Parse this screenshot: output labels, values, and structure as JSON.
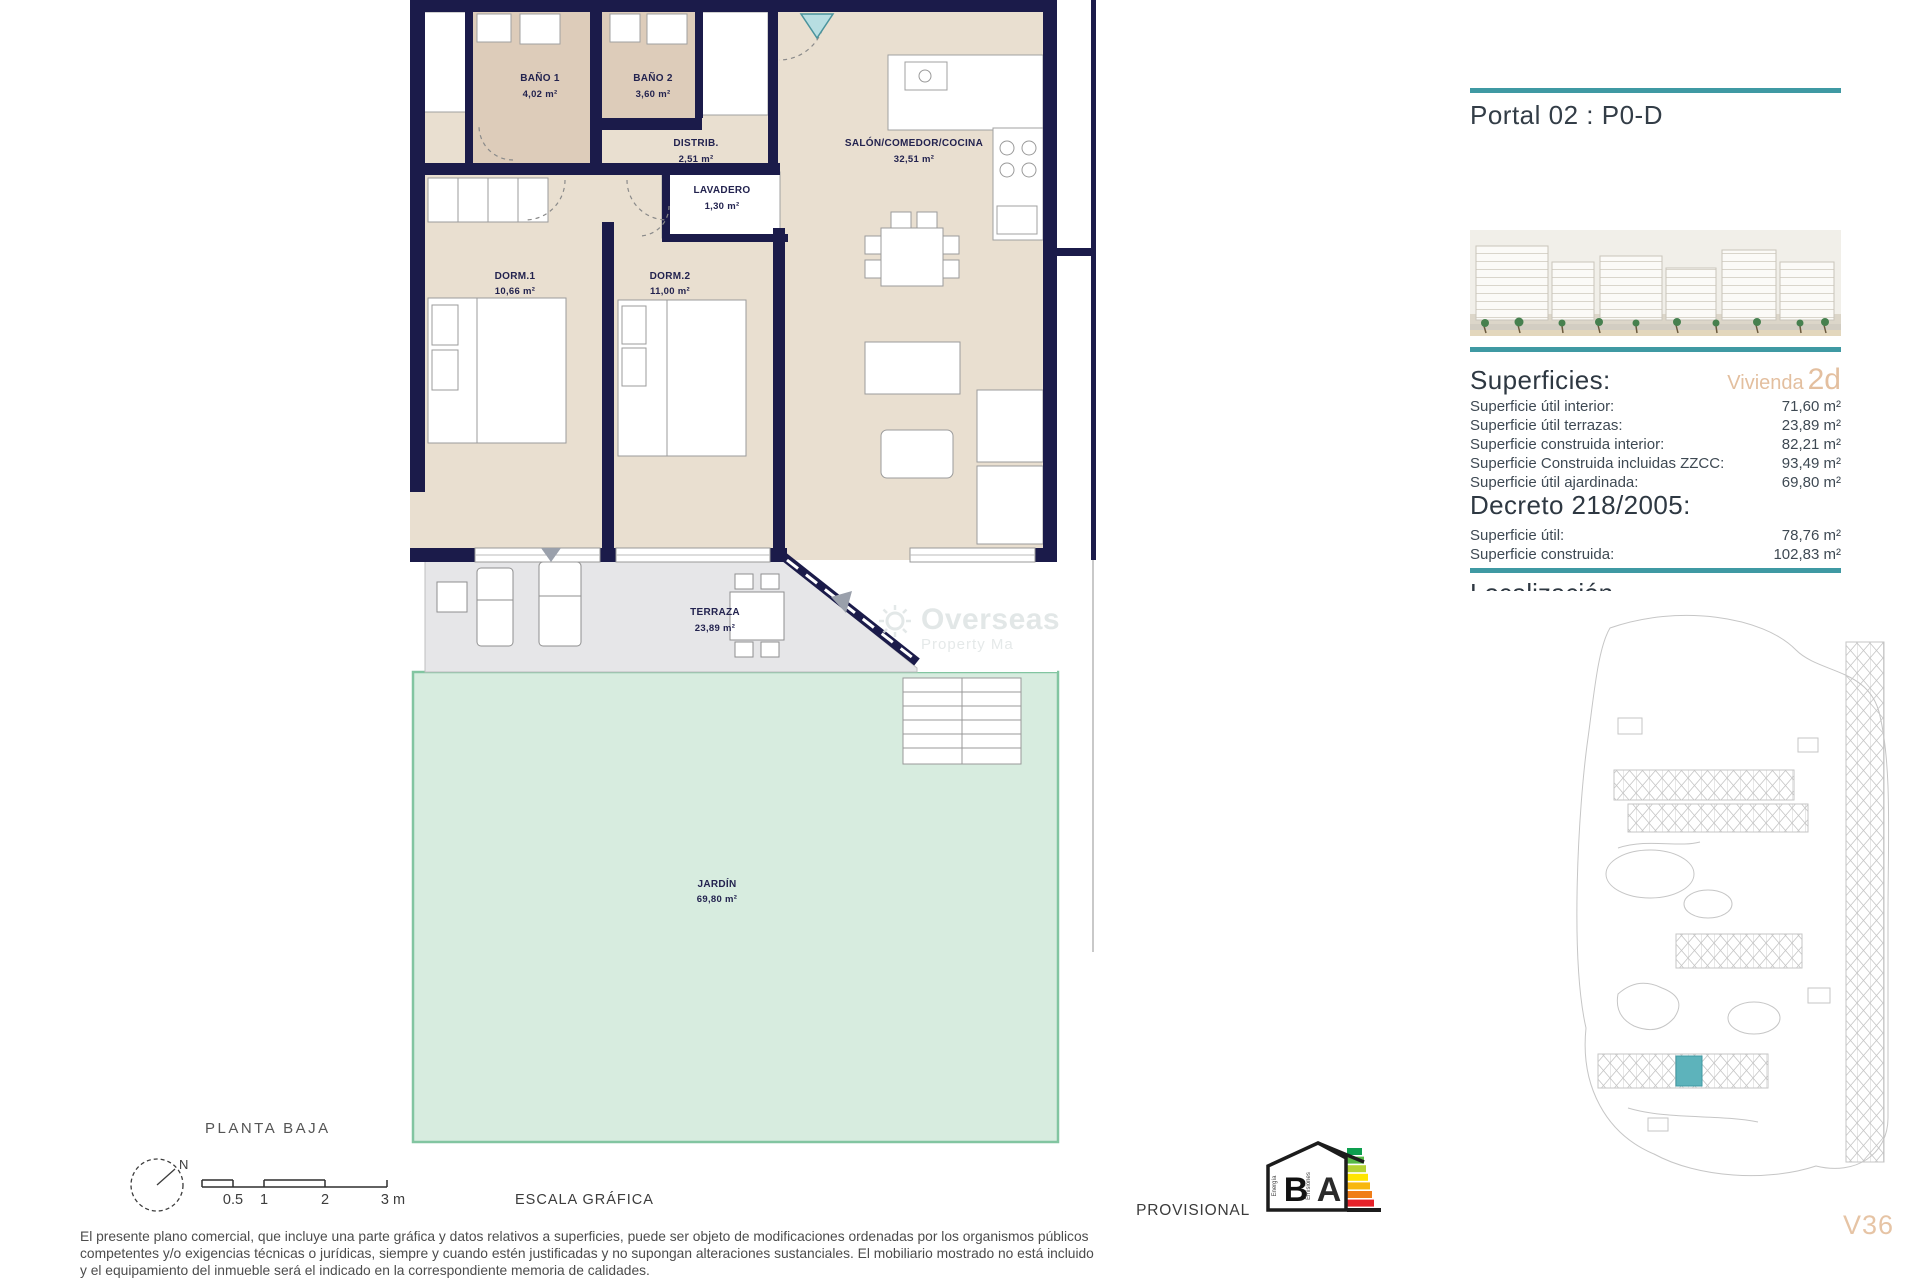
{
  "accent_color": "#3F99A3",
  "highlight_color": "#E5C2A2",
  "wall_color": "#1B1B4A",
  "garden_color": "#D7ECDF",
  "header": {
    "title": "Portal 02 : P0-D"
  },
  "superficies": {
    "heading": "Superficies:",
    "vivienda_label": "Vivienda",
    "vivienda_code": "2d",
    "rows": [
      {
        "label": "Superficie útil interior:",
        "value": "71,60 m²"
      },
      {
        "label": "Superficie útil terrazas:",
        "value": "23,89 m²"
      },
      {
        "label": "Superficie construida interior:",
        "value": "82,21 m²"
      },
      {
        "label": "Superficie Construida incluidas ZZCC:",
        "value": "93,49 m²"
      },
      {
        "label": "Superficie útil ajardinada:",
        "value": "69,80 m²"
      }
    ]
  },
  "decreto": {
    "heading": "Decreto 218/2005:",
    "rows": [
      {
        "label": "Superficie útil:",
        "value": "78,76 m²"
      },
      {
        "label": "Superficie construida:",
        "value": "102,83 m²"
      }
    ]
  },
  "clipped_heading": "Localización",
  "plan": {
    "rooms": [
      {
        "name": "BAÑO 1",
        "area": "4,02 m²"
      },
      {
        "name": "BAÑO 2",
        "area": "3,60 m²"
      },
      {
        "name": "DISTRIB.",
        "area": "2,51 m²"
      },
      {
        "name": "LAVADERO",
        "area": "1,30 m²"
      },
      {
        "name": "SALÓN/COMEDOR/COCINA",
        "area": "32,51 m²"
      },
      {
        "name": "DORM.1",
        "area": "10,66 m²"
      },
      {
        "name": "DORM.2",
        "area": "11,00 m²"
      },
      {
        "name": "TERRAZA",
        "area": "23,89 m²"
      },
      {
        "name": "JARDÍN",
        "area": "69,80 m²"
      }
    ],
    "floor_label": "PLANTA BAJA",
    "compass_label": "N"
  },
  "scale_bar": {
    "ticks": [
      "0.5",
      "1",
      "2",
      "3 m"
    ],
    "label": "ESCALA GRÁFICA"
  },
  "watermark": {
    "line1": "Overseas",
    "line2": "Property Ma"
  },
  "energy": {
    "provisional_label": "PROVISIONAL",
    "letter_left": "B",
    "letter_right": "A",
    "word_left": "Energía",
    "word_right": "Emisiones"
  },
  "footer": {
    "disclaimer_lines": [
      "El presente plano comercial, que incluye una parte gráfica y datos relativos a superficies, puede ser objeto de modificaciones ordenadas por los organismos públicos",
      "competentes y/o exigencias técnicas o jurídicas, siempre y cuando estén justificadas y no supongan alteraciones sustanciales. El mobiliario mostrado no está incluido",
      "y el equipamiento del inmueble será el indicado en la correspondiente memoria de calidades."
    ]
  },
  "reference": "V36"
}
